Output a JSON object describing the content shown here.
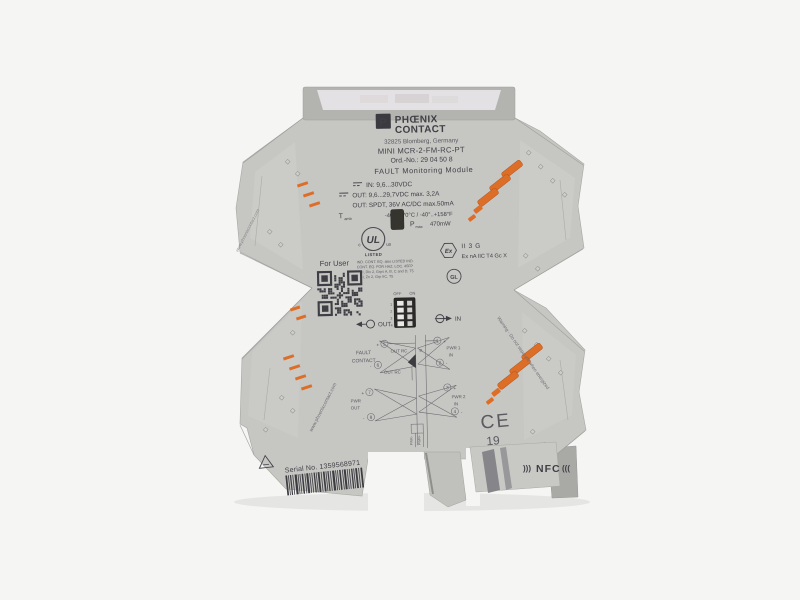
{
  "scene": {
    "background": "#f5f5f4",
    "body_gray": "#c6c6c3",
    "cap_gray": "#b3b3b0",
    "window_tint": "#e7e5e7",
    "orange": "#dd6e28",
    "print": "#3f3f45"
  },
  "brand": {
    "logo_letter": "P",
    "name_top": "PHŒNIX",
    "name_bottom": "CONTACT",
    "address": "32825 Blomberg, Germany",
    "model": "MINI MCR-2-FM-RC-PT",
    "order_no": "Ord.-No.: 29 04 50 8",
    "module_type": "FAULT Monitoring Module"
  },
  "specs": {
    "line_in": "IN: 9,6...30VDC",
    "line_out1": "OUT: 9,6...29,7VDC max. 3,2A",
    "line_out2": "OUT: SPDT, 36V AC/DC max.50mA",
    "tamb_label": "T",
    "tamb_sub": "amb",
    "tamb_value": "-40°..+70°C / -40°..+158°F",
    "pmax_label": "P",
    "pmax_sub": "max",
    "pmax_value": "470mW"
  },
  "ul": {
    "mark": "UL",
    "c": "c",
    "us": "us",
    "listed": "LISTED",
    "lines": [
      "IND. CONT. EQ. also LISTED IND.",
      "CONT. EQ. FOR HAZ. LOC. 45FP",
      "CL I, Div 2, Grps A, B, C and D, T5",
      "CL I, Zn 2, Grp IIC, T5"
    ]
  },
  "ex": {
    "symbol": "Ex",
    "line1": "II 3 G",
    "line2": "Ex nA IIC T4 Gc X",
    "gl": "GL"
  },
  "ce": {
    "mark": "CE",
    "year": "19"
  },
  "dip": {
    "off": "OFF",
    "on": "ON",
    "rows": [
      "1",
      "2",
      "3",
      "4"
    ]
  },
  "io": {
    "out": "OUT",
    "in": "IN"
  },
  "user": {
    "for_user": "For User"
  },
  "diagram": {
    "fault_line1": "FAULT",
    "fault_line2": "CONTACT",
    "out_rc_top": "OUT RC",
    "out_rc_bottom": "OUT RC",
    "pwr_out_1": "PWR",
    "pwr_out_2": "OUT",
    "pwr1_1": "PWR 1",
    "pwr1_2": "IN",
    "pwr2_1": "PWR 2",
    "pwr2_2": "IN",
    "t1": "1",
    "t2": "2",
    "t3": "3",
    "t4": "4",
    "t5": "5",
    "t6": "6",
    "t7": "7",
    "t8": "8",
    "plus": "+",
    "minus": "-",
    "si": "SI",
    "pwr_minus": "PWR-",
    "pwr_plus": "PWR+"
  },
  "footer": {
    "serial": "Serial No. 1359568971",
    "nfc_left": ")))",
    "nfc": "NFC",
    "nfc_right": "((("
  },
  "side": {
    "website": "www.phoenixcontact.com",
    "warning": "Warning - Do not separate when energized"
  }
}
